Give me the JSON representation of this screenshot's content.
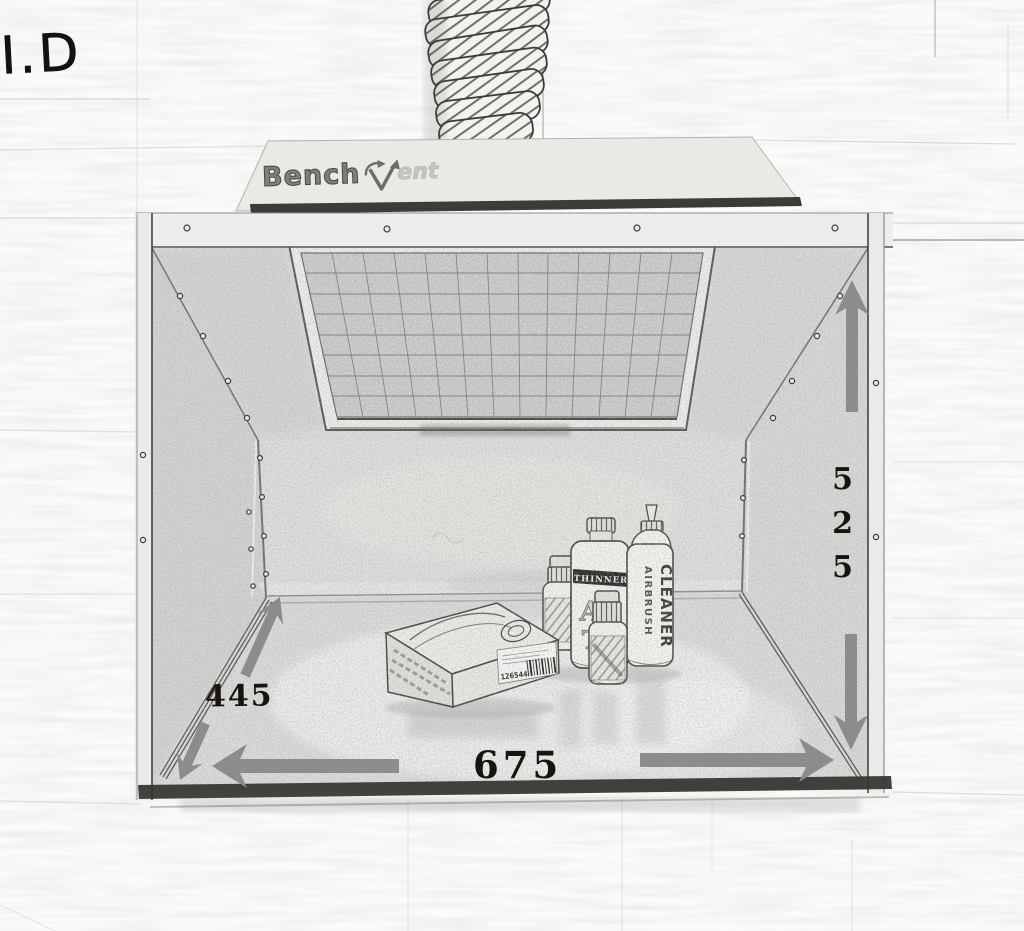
{
  "scene": {
    "annotation": "I.D"
  },
  "logo": {
    "text_primary": "Bench",
    "text_secondary": "ent"
  },
  "dimensions": {
    "width": "675",
    "depth": "445",
    "height": "525"
  },
  "products": {
    "glove_box": {
      "barcode": "126544"
    },
    "thinner_bottle": {
      "band_label": "THINNER",
      "big_letters_top": "AC",
      "big_letters_bottom": "TI"
    },
    "cleaner_bottle": {
      "label_top": "AIRBRUSH",
      "label_bottom": "CLEANER"
    }
  },
  "colors": {
    "arrow": "#8c8c8c",
    "dimension_text": "#17130e",
    "sketch_line": "#44423e",
    "background": "#fafaf8"
  }
}
